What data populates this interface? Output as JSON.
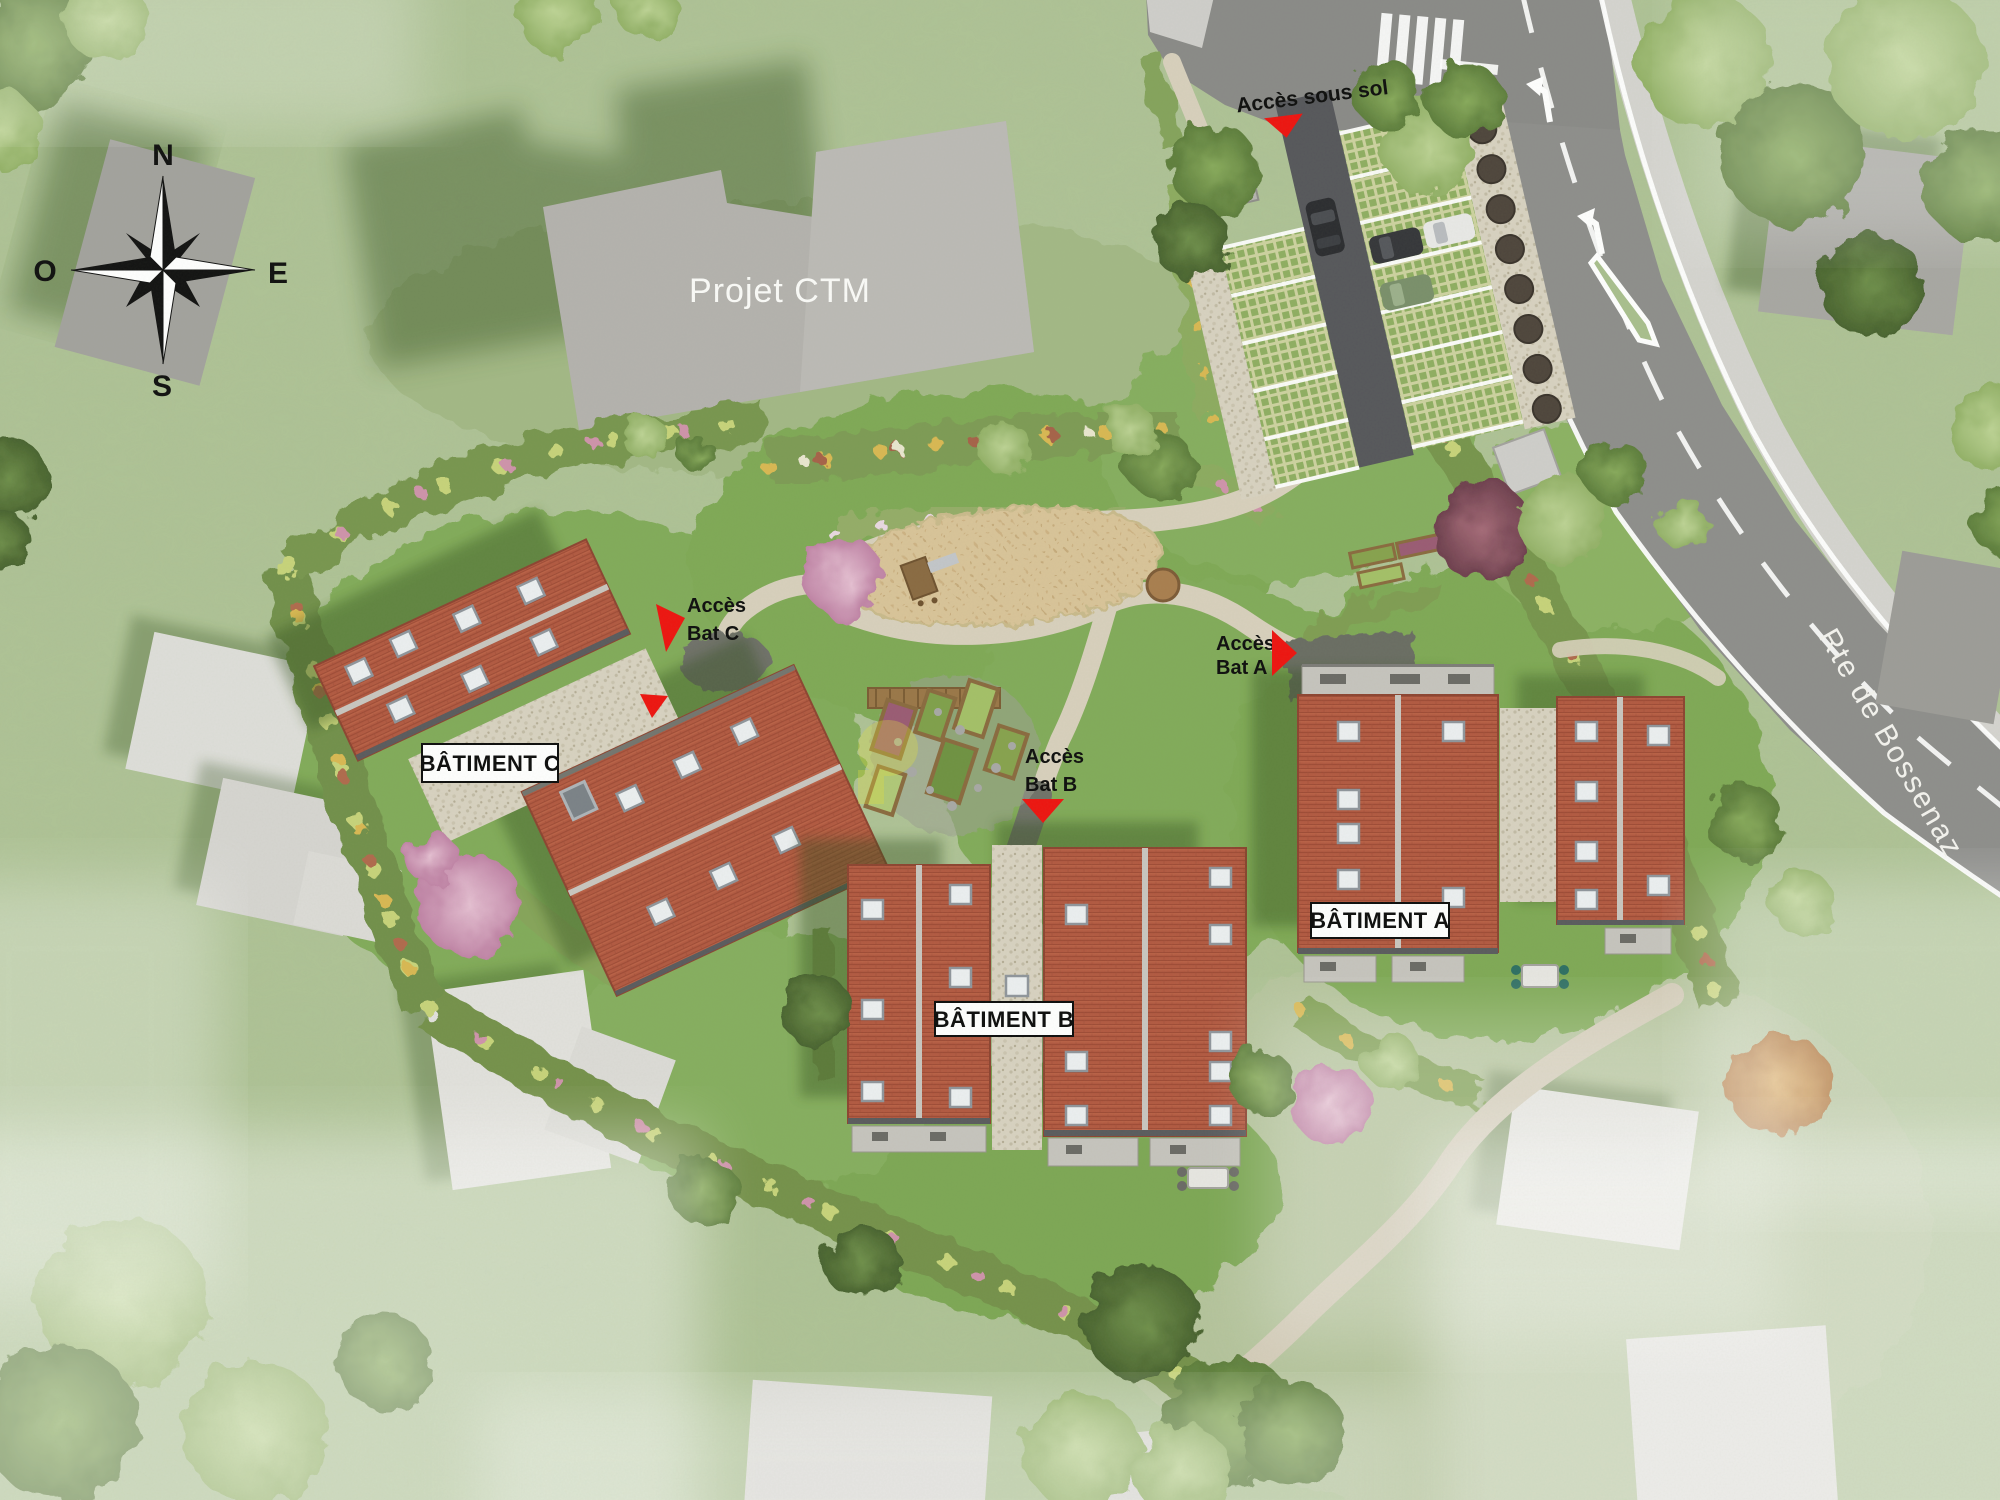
{
  "map": {
    "compass": {
      "north": "N",
      "east": "E",
      "south": "S",
      "west": "O"
    },
    "neighborhood": {
      "ctm_label": "Projet CTM",
      "road_name": "Rte de Bossenaz"
    },
    "buildings": [
      {
        "id": "A",
        "label": "BÂTIMENT A"
      },
      {
        "id": "B",
        "label": "BÂTIMENT B"
      },
      {
        "id": "C",
        "label": "BÂTIMENT C"
      }
    ],
    "access_points": [
      {
        "id": "basement",
        "label": "Accès sous sol"
      },
      {
        "id": "bat-a",
        "line1": "Accès",
        "line2": "Bat A"
      },
      {
        "id": "bat-b",
        "line1": "Accès",
        "line2": "Bat B"
      },
      {
        "id": "bat-c",
        "line1": "Accès",
        "line2": "Bat C"
      }
    ],
    "colors": {
      "marker_red": "#ee1410",
      "roof_red": "#b25941",
      "site_grass": "#82ab5a",
      "outer_grass": "#aec296",
      "road_asphalt": "#8e8e8c",
      "neighbor_gray": "#b4b2ae",
      "house_light": "#e0dfdb",
      "path_beige": "#d8d0bd",
      "label_bg": "#ffffff",
      "label_text": "#111111"
    }
  }
}
